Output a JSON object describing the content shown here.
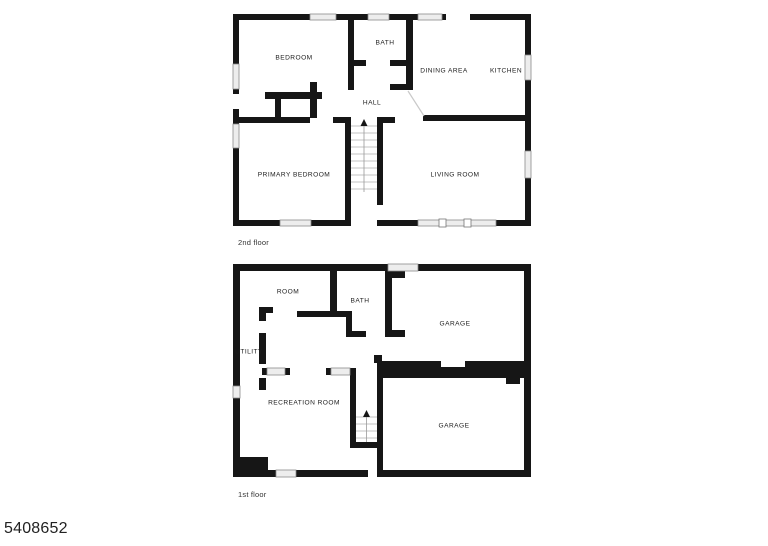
{
  "page": {
    "mls_number": "5408652",
    "background": "#ffffff"
  },
  "colors": {
    "wall": "#161616",
    "window_fill": "#ededed",
    "window_stroke": "#8a8a8a",
    "stair_tread": "#c3c3c3",
    "label_text": "#1c1c1c"
  },
  "floors": [
    {
      "id": "second-floor",
      "caption": {
        "text": "2nd floor",
        "x": 238,
        "y": 238
      },
      "rooms": [
        {
          "name": "BEDROOM",
          "x": 294,
          "y": 58
        },
        {
          "name": "BATH",
          "x": 385,
          "y": 43
        },
        {
          "name": "DINING AREA",
          "x": 444,
          "y": 71
        },
        {
          "name": "KITCHEN",
          "x": 506,
          "y": 71
        },
        {
          "name": "HALL",
          "x": 372,
          "y": 103
        },
        {
          "name": "PRIMARY BEDROOM",
          "x": 294,
          "y": 175
        },
        {
          "name": "LIVING ROOM",
          "x": 455,
          "y": 175
        }
      ],
      "stairs_direction": "up"
    },
    {
      "id": "first-floor",
      "caption": {
        "text": "1st floor",
        "x": 238,
        "y": 490
      },
      "rooms": [
        {
          "name": "ROOM",
          "x": 288,
          "y": 292
        },
        {
          "name": "BATH",
          "x": 360,
          "y": 301
        },
        {
          "name": "GARAGE",
          "x": 455,
          "y": 324
        },
        {
          "name": "UTILITY",
          "x": 249,
          "y": 352
        },
        {
          "name": "RECREATION ROOM",
          "x": 304,
          "y": 403
        },
        {
          "name": "GARAGE",
          "x": 454,
          "y": 426
        }
      ],
      "stairs_direction": "up"
    }
  ]
}
